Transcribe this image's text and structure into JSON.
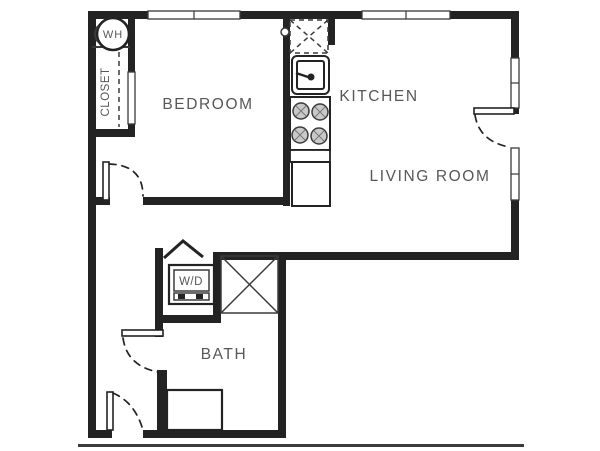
{
  "colors": {
    "walls": "#232323",
    "thin_lines": "#3a3a3a",
    "label_text": "#575757",
    "background": "#ffffff"
  },
  "labels": {
    "bedroom": "BEDROOM",
    "kitchen": "KITCHEN",
    "living_room": "LIVING ROOM",
    "bath": "BATH",
    "closet": "CLOSET",
    "water_heater": "WH",
    "washer_dryer": "W/D"
  }
}
